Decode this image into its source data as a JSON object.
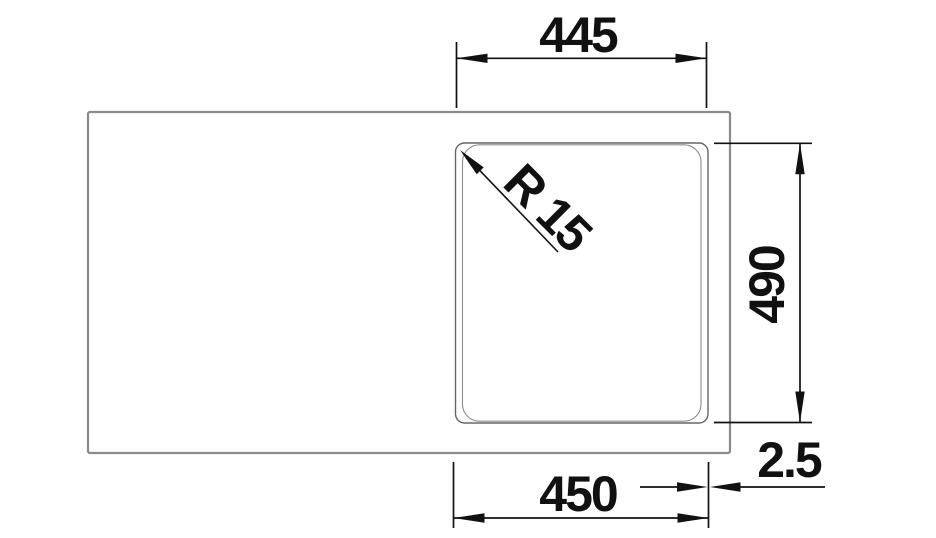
{
  "drawing": {
    "type": "sink-plan-view-dimension-drawing",
    "dimensions": {
      "top_width": "445",
      "bowl_depth": "490",
      "bottom_width": "450",
      "rim_thickness": "2.5",
      "corner_radius": "R 15"
    },
    "colors": {
      "background": "#ffffff",
      "sink_outline": "#8a8a8a",
      "bowl_outline": "#666666",
      "bowl_inner_line": "#8d8d8d",
      "dimension": "#111111"
    }
  }
}
